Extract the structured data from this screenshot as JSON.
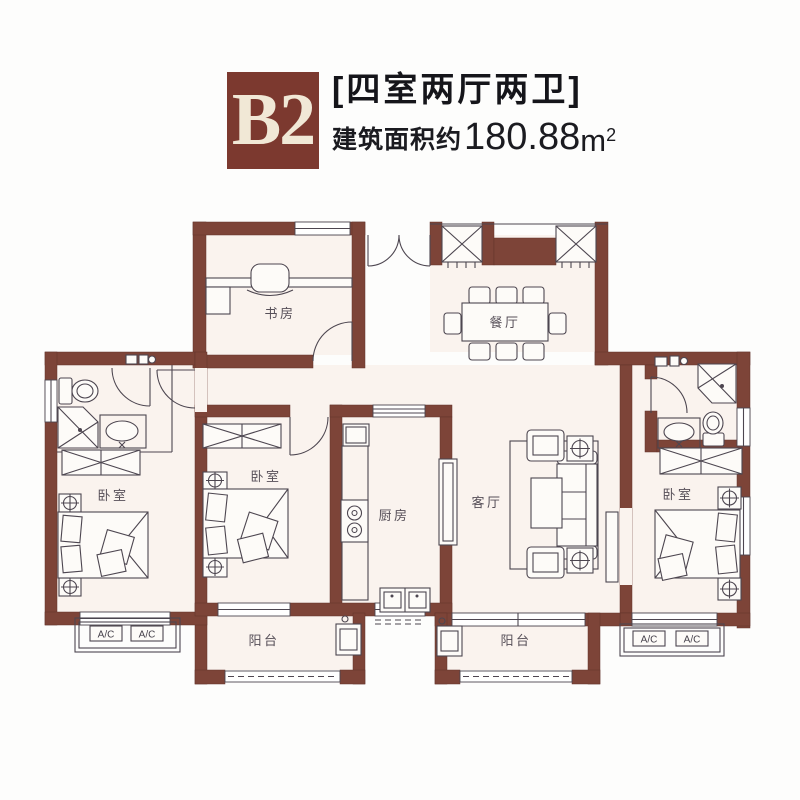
{
  "header": {
    "unit_label": "B2",
    "layout_title": "[四室两厅两卫]",
    "area_prefix": "建筑面积约",
    "area_value": "180.88",
    "area_unit": "m",
    "area_exponent": "2"
  },
  "rooms": {
    "study": "书房",
    "dining": "餐厅",
    "bedroom_left": "卧室",
    "bedroom_middle": "卧室",
    "bedroom_right": "卧室",
    "kitchen": "厨房",
    "living": "客厅",
    "balcony_left": "阳台",
    "balcony_right": "阳台"
  },
  "ac_units": [
    "A/C",
    "A/C",
    "A/C",
    "A/C"
  ],
  "colors": {
    "wall": "#7d4438",
    "header_box": "#7c392f",
    "header_text": "#f1e8d6",
    "line": "#4d4650",
    "title_text": "#15151a"
  }
}
